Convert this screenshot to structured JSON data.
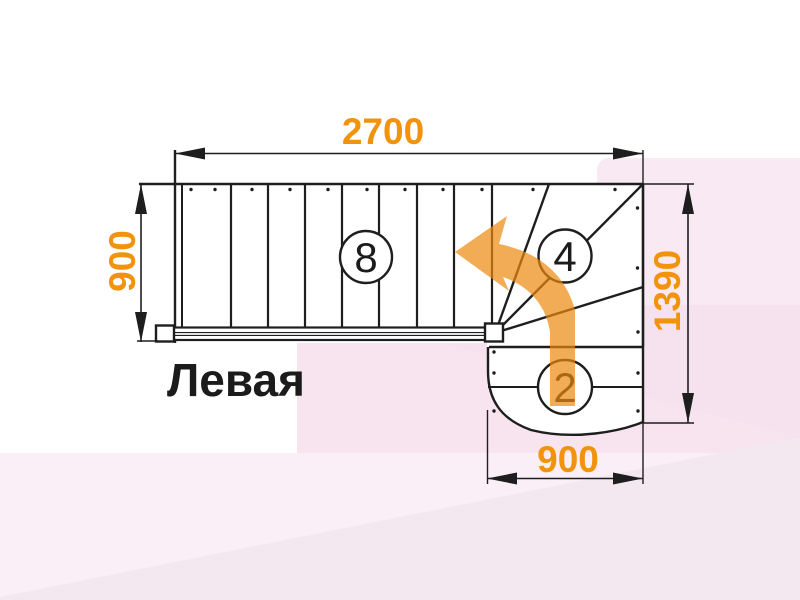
{
  "drawing": {
    "label": "Левая",
    "dimensions": {
      "flight_length": "2700",
      "flight_width": "900",
      "side_length": "1390",
      "lower_width": "900"
    },
    "step_counts": {
      "straight": "8",
      "winder": "4",
      "lower": "2"
    }
  },
  "colors": {
    "dimension_text": "#F2930D",
    "arrow_orange": "#EE890E",
    "line": "#1E1E1E",
    "label_text": "#1B1B1B",
    "bg_pink_right": "#F8E9F3",
    "bg_pink_mid": "#F7E4EF",
    "bg_pink_band": "#FAEFF6",
    "bg_pink_wedge": "#F3E7F0"
  }
}
